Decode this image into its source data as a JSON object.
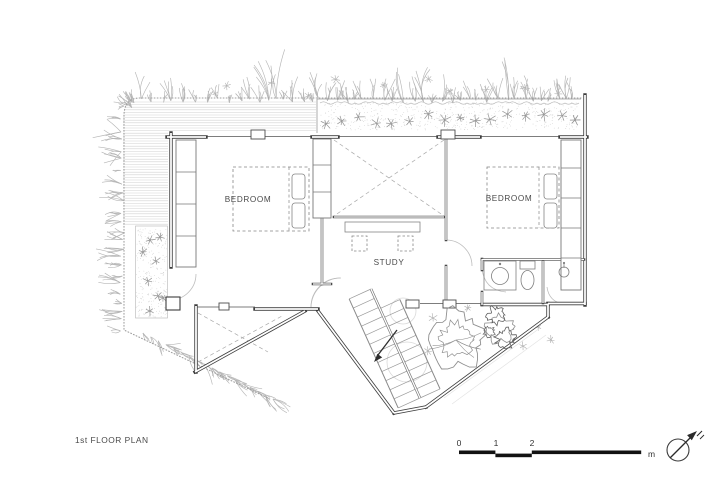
{
  "page": {
    "background": "#ffffff"
  },
  "plan": {
    "title": "1st FLOOR PLAN",
    "rooms": {
      "bedroom_left": "BEDROOM",
      "bedroom_right": "BEDROOM",
      "study": "STUDY"
    },
    "scale_bar": {
      "ticks": [
        "0",
        "1",
        "2",
        "5"
      ],
      "unit": "m"
    },
    "icons": {
      "north_arrow": "north-arrow-compass"
    },
    "colors": {
      "wall": "#3d3d3d",
      "wall_inner": "#4a4a4a",
      "thin_line": "#8a8a8a",
      "furniture": "#858585",
      "dashed": "#a8a8a8",
      "vegetation": "#b6b6b6",
      "plant_symbol": "#949494",
      "stipple": "#c9c9c9",
      "hatch": "#d2d2d2",
      "tree": "#8f8f8f",
      "tree_dark": "#616161",
      "faint": "#d9d9d9",
      "text": "#4a4a4a",
      "scale_bar": "#121212"
    }
  }
}
